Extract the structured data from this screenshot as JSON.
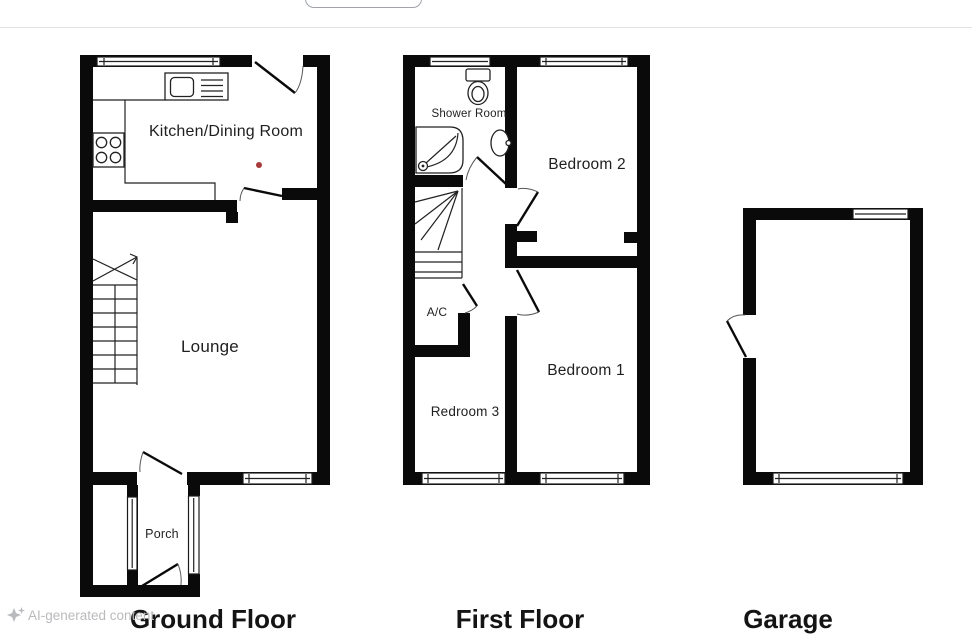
{
  "floors": {
    "ground": {
      "title": "Ground Floor",
      "rooms": {
        "kitchen_dining": "Kitchen/Dining Room",
        "lounge": "Lounge",
        "porch": "Porch"
      }
    },
    "first": {
      "title": "First Floor",
      "rooms": {
        "shower_room": "Shower Room",
        "bedroom2": "Bedroom 2",
        "bedroom1": "Bedroom 1",
        "bedroom3": "Redroom 3",
        "ac": "A/C"
      }
    },
    "garage": {
      "title": "Garage"
    }
  },
  "watermark": {
    "label": "AI-generated content",
    "icon": "sparkle-icon"
  },
  "colors": {
    "wall": "#0a0a0a",
    "marker_red": "#a83a38",
    "watermark_gray": "#b9babd",
    "divider_gray": "#e3e3e6",
    "button_border": "#a0a3a9"
  }
}
